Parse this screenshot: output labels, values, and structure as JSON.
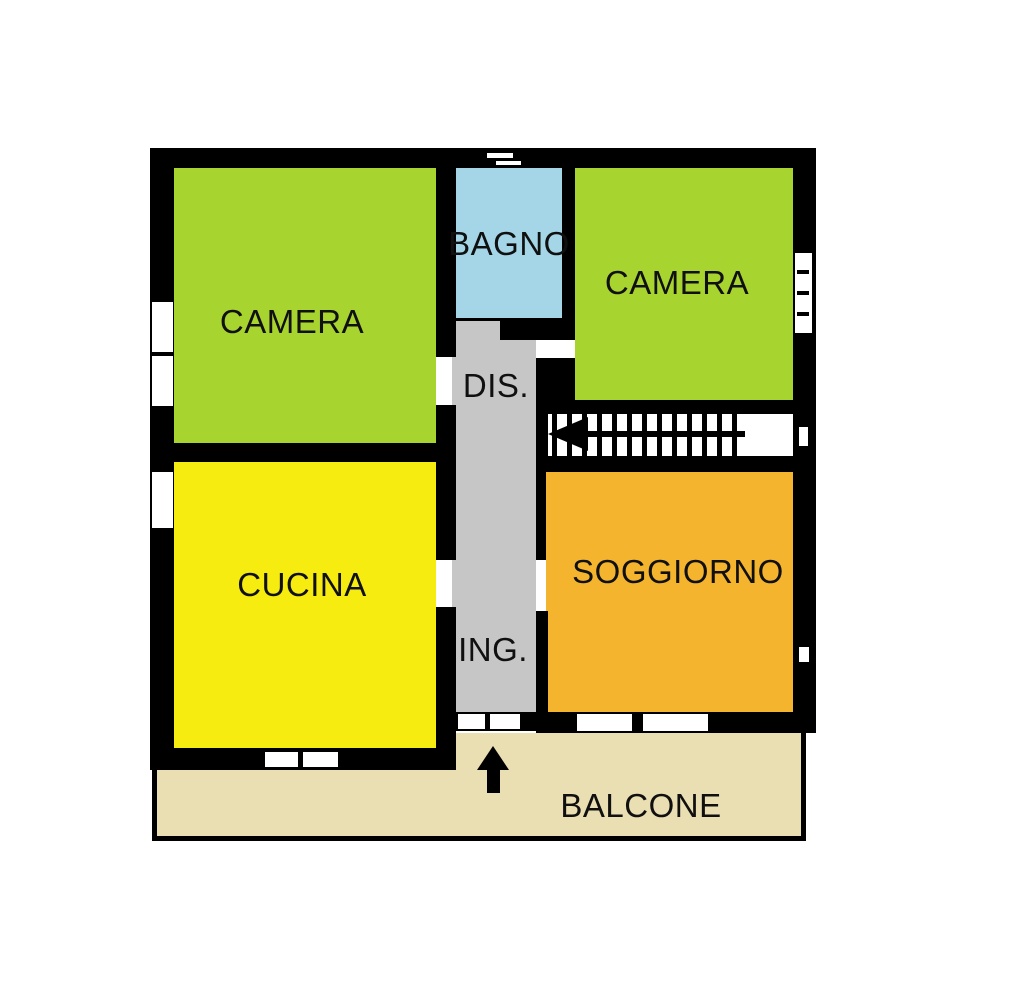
{
  "plan": {
    "title": "Apartment floor plan",
    "wall_color": "#000000",
    "background_color": "#ffffff",
    "rooms": [
      {
        "name": "camera-1",
        "label": "CAMERA",
        "color": "#a8d42f"
      },
      {
        "name": "bagno",
        "label": "BAGNO",
        "color": "#a4d6e8"
      },
      {
        "name": "camera-2",
        "label": "CAMERA",
        "color": "#a8d42f"
      },
      {
        "name": "disimpegno",
        "label": "DIS.",
        "color": "#c6c6c6"
      },
      {
        "name": "cucina",
        "label": "CUCINA",
        "color": "#f6ec10"
      },
      {
        "name": "soggiorno",
        "label": "SOGGIORNO",
        "color": "#f5b42e"
      },
      {
        "name": "ingresso",
        "label": "ING.",
        "color": "#c6c6c6"
      },
      {
        "name": "balcone",
        "label": "BALCONE",
        "color": "#eadeb3"
      }
    ],
    "icons": [
      {
        "name": "stairs-direction-arrow",
        "meaning": "stairs run direction (left)"
      },
      {
        "name": "entrance-arrow",
        "meaning": "entrance from balcony (up)"
      }
    ]
  }
}
